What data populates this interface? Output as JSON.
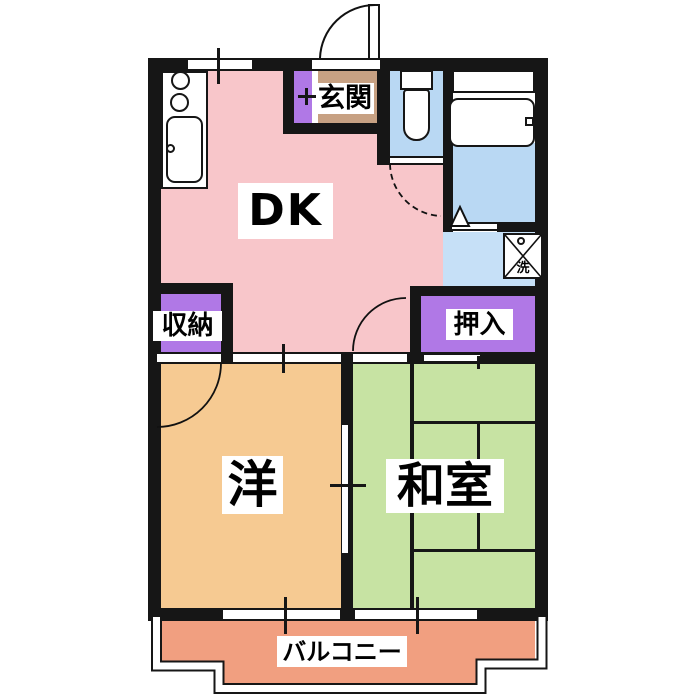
{
  "title": "apartment-floorplan",
  "rooms": {
    "dk": {
      "name": "DK"
    },
    "genkan": {
      "name": "玄関"
    },
    "storage": {
      "name": "収納"
    },
    "oshiire": {
      "name": "押入"
    },
    "western": {
      "name": "洋"
    },
    "washitsu": {
      "name": "和室"
    },
    "balcony": {
      "name": "バルコニー"
    }
  },
  "fixtures": {
    "washer_kanji": "洗"
  },
  "palette": {
    "dk_pink": "#f8c6ca",
    "western_orange": "#f6ca92",
    "washitsu_green": "#c7e3a3",
    "balcony_salmon": "#f19f80",
    "genkan_tan": "#c7a183",
    "closet_purple": "#b078e6",
    "bath_blue": "#b9d8f3",
    "washroom_blue": "#c6e0f7",
    "wall_black": "#161616",
    "paper_white": "#ffffff"
  }
}
